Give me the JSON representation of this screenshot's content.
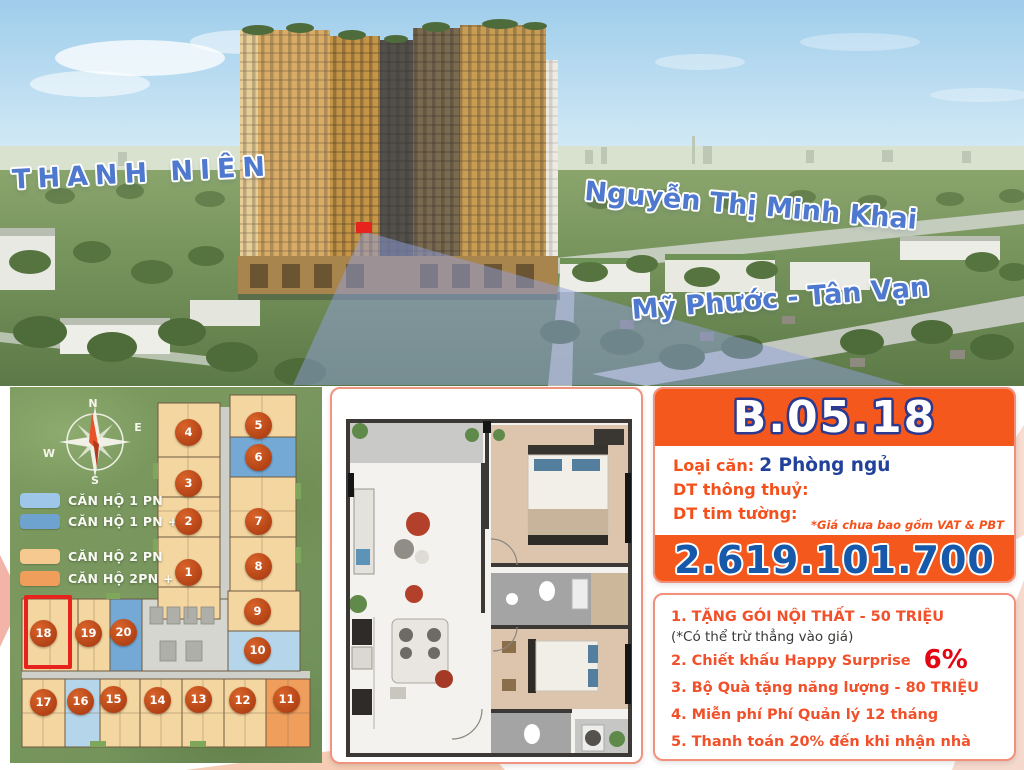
{
  "hero": {
    "street_labels": [
      {
        "name": "thanh-nien",
        "text": "THANH NIÊN"
      },
      {
        "name": "nguyen-thi-minh-khai",
        "text": "Nguyễn Thị Minh Khai"
      },
      {
        "name": "my-phuoc-tan-van",
        "text": "Mỹ Phước - Tân Vạn"
      }
    ],
    "label_color": "#4E79CF",
    "marker_color": "#E6241D"
  },
  "siteplan": {
    "compass": {
      "n": "N",
      "e": "E",
      "s": "S",
      "w": "W"
    },
    "legend": [
      {
        "label": "CĂN HỘ 1 PN",
        "color": "#9DC6E8"
      },
      {
        "label": "CĂN HỘ 1 PN +",
        "color": "#6FA3CF"
      },
      {
        "label": "CĂN HỘ 2 PN",
        "color": "#F5C98F"
      },
      {
        "label": "CĂN HỘ 2PN +",
        "color": "#EF9E5B"
      }
    ],
    "units": [
      "1",
      "2",
      "3",
      "4",
      "5",
      "6",
      "7",
      "8",
      "9",
      "10",
      "11",
      "12",
      "13",
      "14",
      "15",
      "16",
      "17",
      "18",
      "19",
      "20"
    ],
    "highlighted_unit": "18",
    "highlight_color": "#E6241D"
  },
  "info": {
    "unit_code": "B.05.18",
    "type_label": "Loại căn:",
    "type_value": "2 Phòng ngủ",
    "net_area_label": "DT thông thuỷ:",
    "gross_area_label": "DT tim tường:",
    "vat_note": "*Giá chưa bao gồm VAT & PBT",
    "price": "2.619.101.700",
    "accent_orange": "#F4581C",
    "price_blue": "#1658A9",
    "label_red": "#F4511D",
    "value_navy": "#21419B"
  },
  "promos": {
    "p1": "1. TẶNG GÓI NỘI THẤT - 50 TRIỆU",
    "p1_note": "(*Có thể trừ thẳng vào giá)",
    "p2": "2. Chiết khấu Happy Surprise",
    "p2_big": "6%",
    "p3": "3. Bộ Quà tặng năng lượng - 80 TRIỆU",
    "p4": "4. Miễn phí Phí Quản lý 12 tháng",
    "p5": "5. Thanh toán 20% đến khi nhận nhà",
    "text_color": "#F1502A",
    "big_color": "#E30613"
  }
}
